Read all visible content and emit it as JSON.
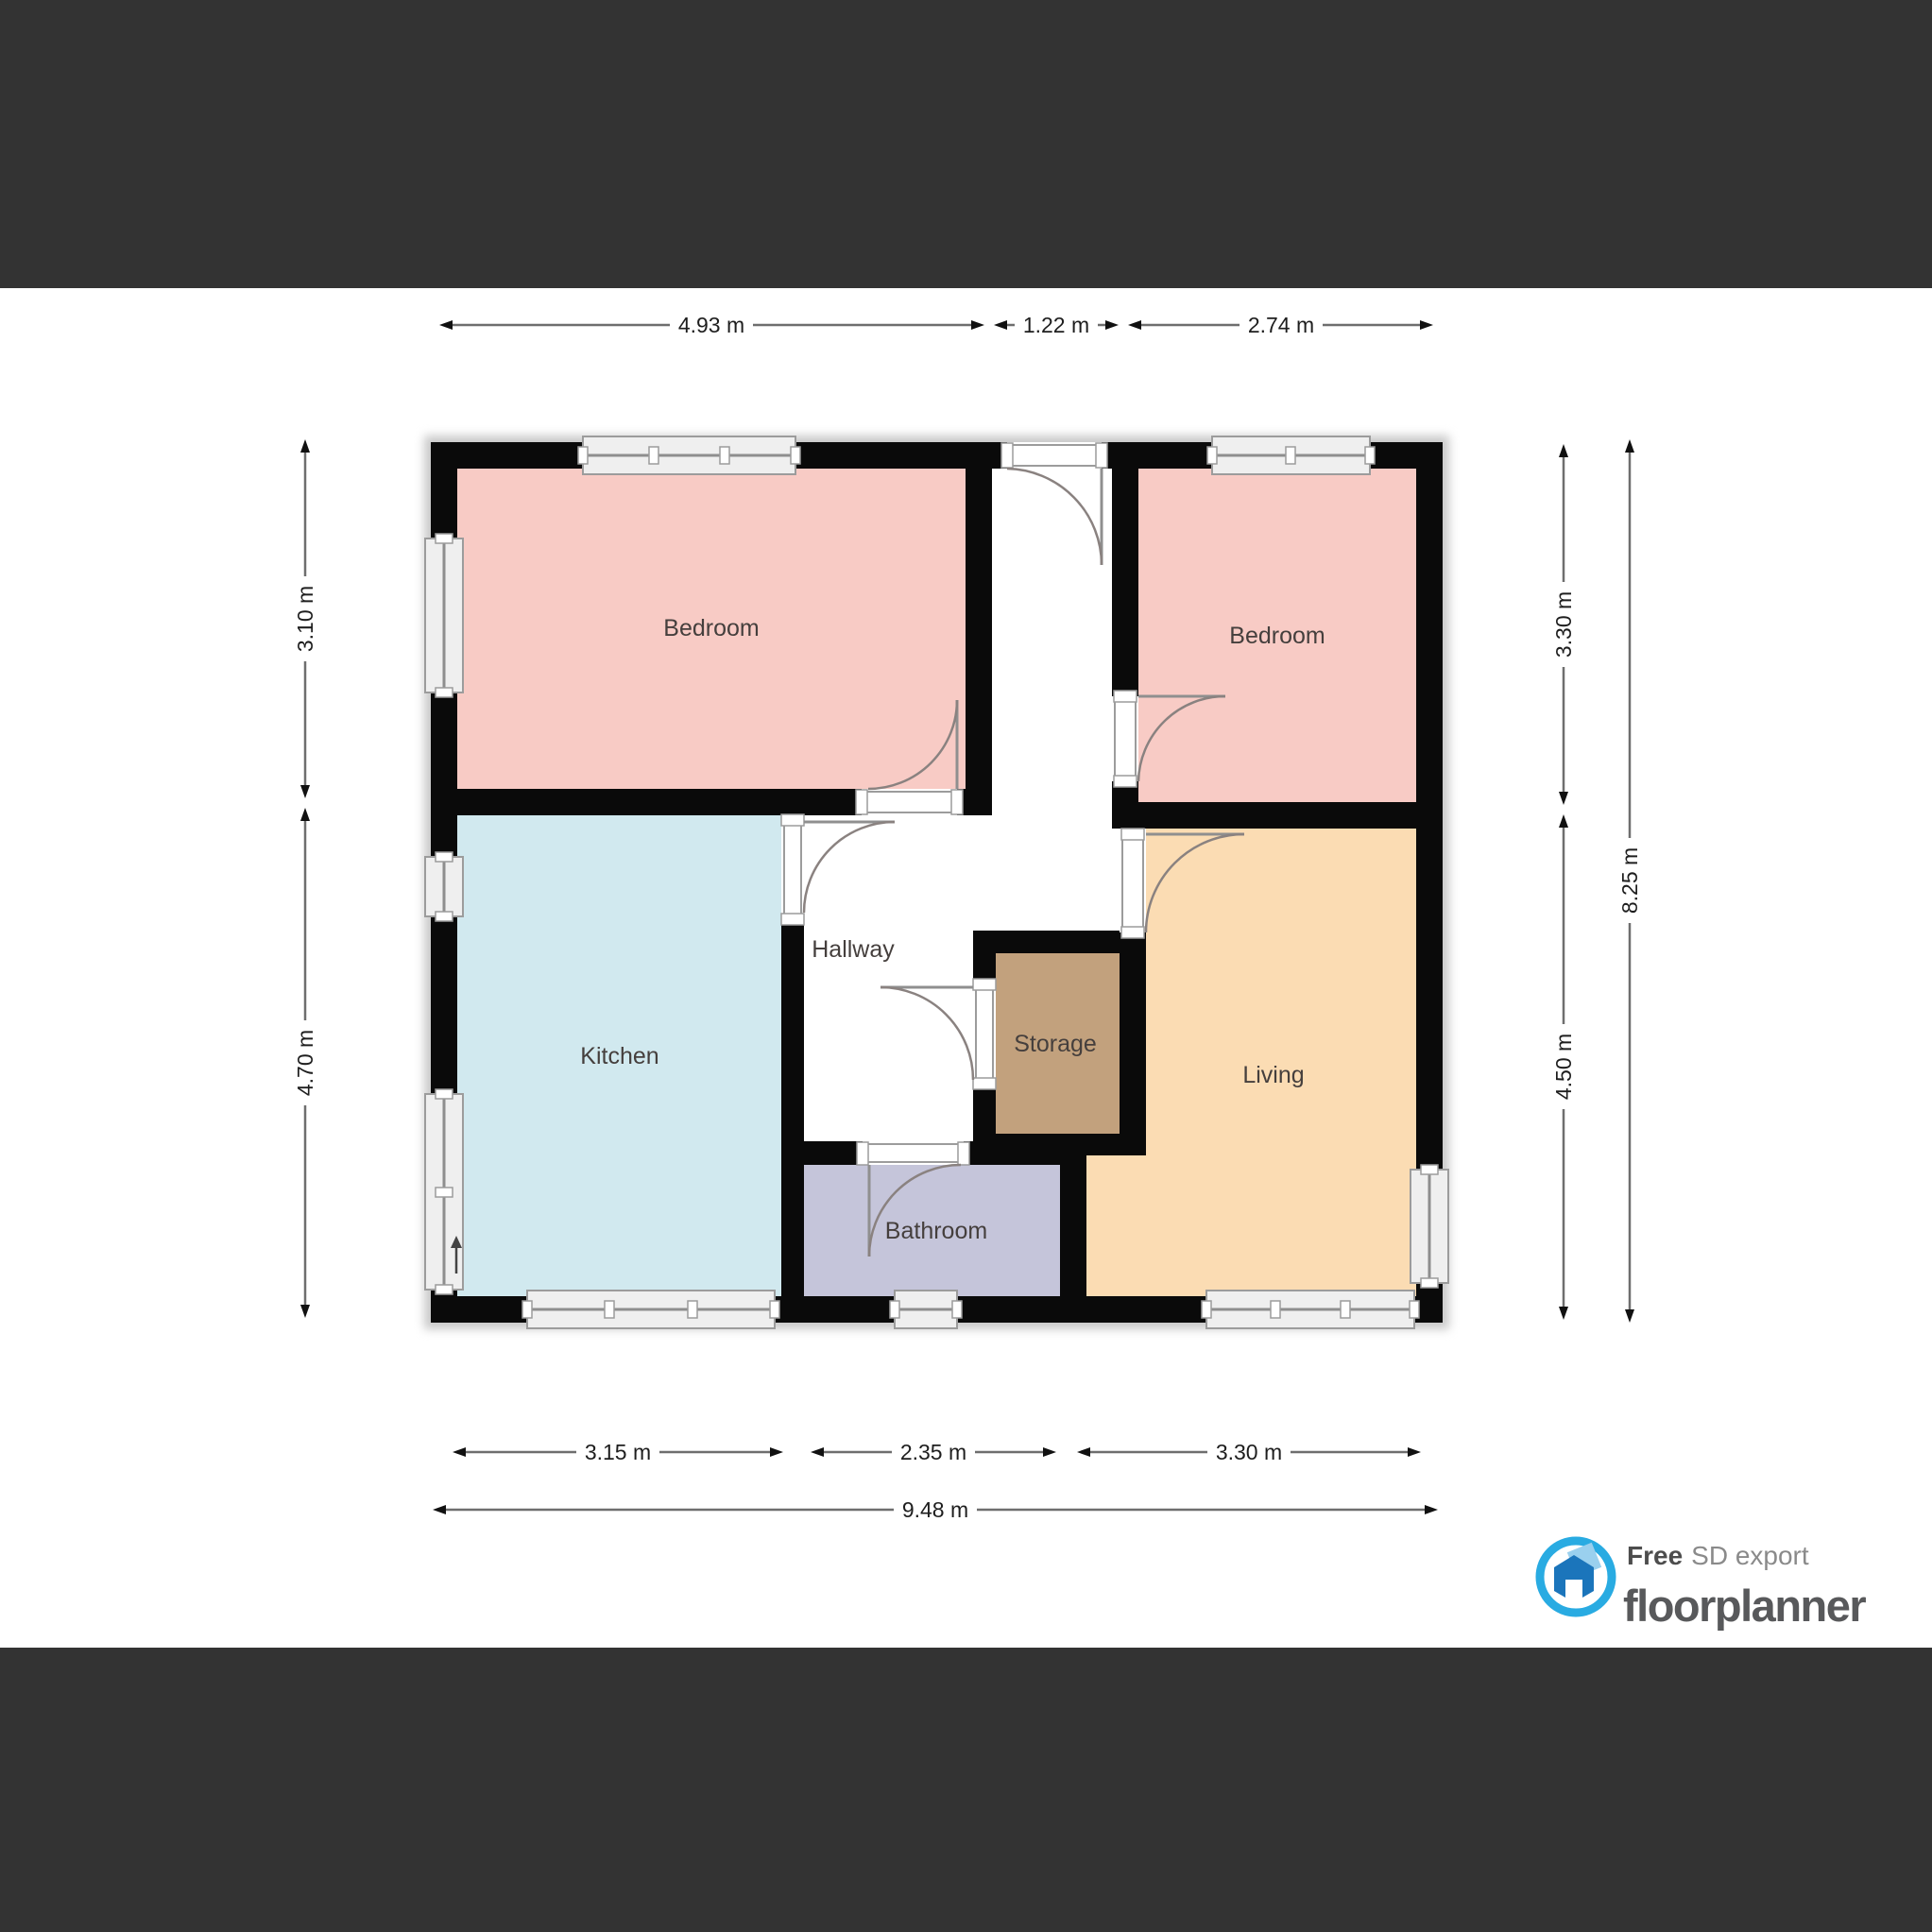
{
  "frame": {
    "bar_color": "#333333",
    "wall_color": "#0a0a0a",
    "plan_bg": "#ffffff"
  },
  "rooms": {
    "bedroom1": {
      "label": "Bedroom",
      "color": "#f8cbc5"
    },
    "bedroom2": {
      "label": "Bedroom",
      "color": "#f8cbc5"
    },
    "kitchen": {
      "label": "Kitchen",
      "color": "#d1e9ef"
    },
    "hallway": {
      "label": "Hallway",
      "color": "#ffffff"
    },
    "storage": {
      "label": "Storage",
      "color": "#c2a17d"
    },
    "living": {
      "label": "Living",
      "color": "#fbdcb3"
    },
    "bathroom": {
      "label": "Bathroom",
      "color": "#c5c5da"
    }
  },
  "dimensions": {
    "top": [
      "4.93 m",
      "1.22 m",
      "2.74 m"
    ],
    "bottom": [
      "3.15 m",
      "2.35 m",
      "3.30 m"
    ],
    "bottom_total": "9.48 m",
    "left": [
      "3.10 m",
      "4.70 m"
    ],
    "right": [
      "3.30 m",
      "4.50 m"
    ],
    "right_total": "8.25 m"
  },
  "branding": {
    "free_label": "Free",
    "export_label": "SD export",
    "app_name": "floorplanner",
    "accent_color": "#29abe2",
    "logo_house_dark": "#1b75bb",
    "logo_house_light": "#9ad0ee",
    "wordmark_color": "#58595b"
  },
  "icons": {
    "logo": "floorplanner-house-icon",
    "entry": "up-arrow-icon"
  }
}
